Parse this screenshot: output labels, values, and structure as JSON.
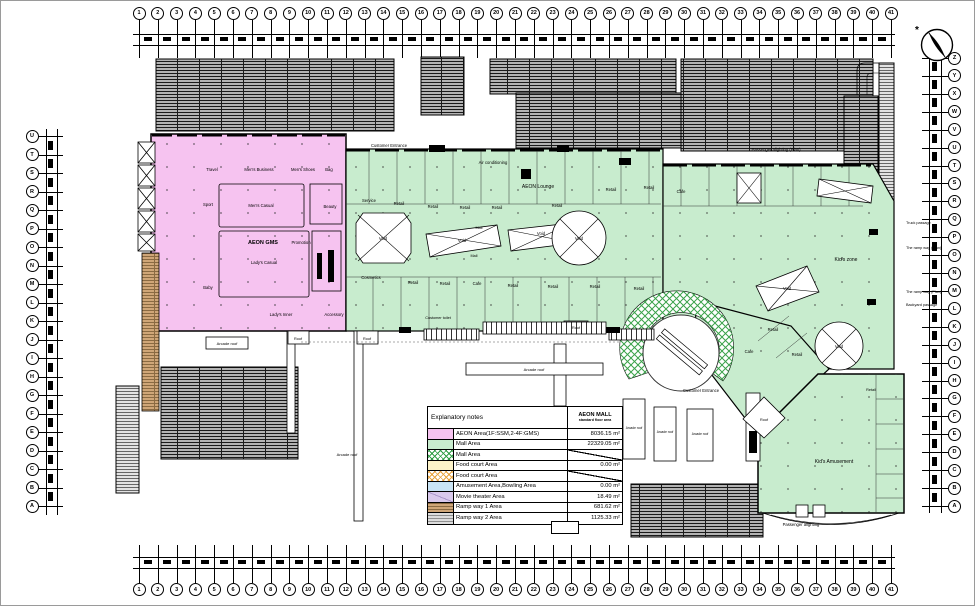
{
  "sheet": {
    "title": "AEON MALL 1F floor plan"
  },
  "colors": {
    "aeon_pink": "#f6c3f0",
    "mall_green": "#c8ecce",
    "food_yellow": "#fdf3c8",
    "amusement_blue": "#c9e4f5",
    "movie_purple": "#d9c9ec",
    "ramp1_tan": "#cfa678",
    "ramp2_gray": "#dcdcdc",
    "crosshatch_green": "#2f9e44",
    "crosshatch_orange": "#e8a33d",
    "roof_gray": "#b3b3b3"
  },
  "grid": {
    "top_numbers": [
      "1",
      "2",
      "3",
      "4",
      "5",
      "6",
      "7",
      "8",
      "9",
      "10",
      "11",
      "12",
      "13",
      "14",
      "15",
      "16",
      "17",
      "18",
      "19",
      "20",
      "21",
      "22",
      "23",
      "24",
      "25",
      "26",
      "27",
      "28",
      "29",
      "30",
      "31",
      "32",
      "33",
      "34",
      "35",
      "36",
      "37",
      "38",
      "39",
      "40",
      "41"
    ],
    "bottom_numbers": [
      "1",
      "2",
      "3",
      "4",
      "5",
      "6",
      "7",
      "8",
      "9",
      "10",
      "11",
      "12",
      "13",
      "14",
      "15",
      "16",
      "17",
      "18",
      "19",
      "20",
      "21",
      "22",
      "23",
      "24",
      "25",
      "26",
      "27",
      "28",
      "29",
      "30",
      "31",
      "32",
      "33",
      "34",
      "35",
      "36",
      "37",
      "38",
      "39",
      "40",
      "41"
    ],
    "left_letters": [
      "U",
      "T",
      "S",
      "R",
      "Q",
      "P",
      "O",
      "N",
      "M",
      "L",
      "K",
      "J",
      "I",
      "H",
      "G",
      "F",
      "E",
      "D",
      "C",
      "B",
      "A"
    ],
    "right_letters": [
      "Z",
      "Y",
      "X",
      "W",
      "V",
      "U",
      "T",
      "S",
      "R",
      "Q",
      "P",
      "O",
      "N",
      "M",
      "L",
      "K",
      "J",
      "I",
      "H",
      "G",
      "F",
      "E",
      "D",
      "C",
      "B",
      "A"
    ]
  },
  "legend": {
    "header_left": "Explanatory notes",
    "header_right_line1": "AEON MALL",
    "header_right_line2": "standard floor area",
    "rows": [
      {
        "swatch": "aeon",
        "label": "AEON Area(1F:SSM,2-4F:GMS)",
        "value": "8036.15 m²",
        "slash": false
      },
      {
        "swatch": "mall",
        "label": "Mall Area",
        "value": "22329.05 m²",
        "slash": false
      },
      {
        "swatch": "mall-cross",
        "label": "Mall Area",
        "value": "",
        "slash": true
      },
      {
        "swatch": "food",
        "label": "Food court Area",
        "value": "0.00 m²",
        "slash": false
      },
      {
        "swatch": "food-cross",
        "label": "Food court Area",
        "value": "",
        "slash": true
      },
      {
        "swatch": "amusement",
        "label": "Amusement Area,Bowling Area",
        "value": "0.00 m²",
        "slash": false
      },
      {
        "swatch": "movie",
        "label": "Movie theater Area",
        "value": "18.49 m²",
        "slash": false
      },
      {
        "swatch": "ramp1",
        "label": "Ramp way 1 Area",
        "value": "681.62 m²",
        "slash": false
      },
      {
        "swatch": "ramp2",
        "label": "Ramp way 2 Area",
        "value": "1125.33 m²",
        "slash": false
      }
    ]
  },
  "plan": {
    "labels": [
      {
        "x": 211,
        "y": 170,
        "t": "Travel"
      },
      {
        "x": 258,
        "y": 170,
        "t": "Men's Business"
      },
      {
        "x": 302,
        "y": 170,
        "t": "Men's Shoes"
      },
      {
        "x": 328,
        "y": 170,
        "t": "Bag"
      },
      {
        "x": 207,
        "y": 205,
        "t": "Sport"
      },
      {
        "x": 260,
        "y": 206,
        "t": "Men's Casual"
      },
      {
        "x": 329,
        "y": 207,
        "t": "Beauty"
      },
      {
        "x": 262,
        "y": 243,
        "t": "AEON GMS",
        "s": 5.5,
        "b": 1
      },
      {
        "x": 300,
        "y": 243,
        "t": "Promotion"
      },
      {
        "x": 263,
        "y": 263,
        "t": "Lady's Casual"
      },
      {
        "x": 207,
        "y": 288,
        "t": "Baby"
      },
      {
        "x": 280,
        "y": 315,
        "t": "Lady's Inner"
      },
      {
        "x": 333,
        "y": 315,
        "t": "Accessory"
      },
      {
        "x": 388,
        "y": 146,
        "t": "Customer Entrance"
      },
      {
        "x": 492,
        "y": 163,
        "t": "Air conditioning"
      },
      {
        "x": 537,
        "y": 187,
        "t": "AEON Lounge",
        "s": 5
      },
      {
        "x": 775,
        "y": 150,
        "t": "Passenger alighting (Plan)"
      },
      {
        "x": 370,
        "y": 278,
        "t": "Cosmetics"
      },
      {
        "x": 845,
        "y": 260,
        "t": "Kid's zone",
        "s": 5
      },
      {
        "x": 833,
        "y": 462,
        "t": "Kid's Amusement",
        "s": 5
      },
      {
        "x": 700,
        "y": 391,
        "t": "Customer Entrance"
      },
      {
        "x": 800,
        "y": 525,
        "t": "Passenger alighting"
      },
      {
        "x": 382,
        "y": 239,
        "t": "Void"
      },
      {
        "x": 461,
        "y": 241,
        "t": "Void"
      },
      {
        "x": 540,
        "y": 234,
        "t": "Void"
      },
      {
        "x": 578,
        "y": 239,
        "t": "Void"
      },
      {
        "x": 838,
        "y": 347,
        "t": "Void"
      },
      {
        "x": 786,
        "y": 289,
        "t": "Void"
      },
      {
        "x": 905,
        "y": 223,
        "t": "Truck passage",
        "s": 3.8,
        "a": "s"
      },
      {
        "x": 905,
        "y": 248,
        "t": "The ramp way (Plan)",
        "s": 3.8,
        "a": "s"
      },
      {
        "x": 905,
        "y": 292,
        "t": "The ramp way (Plan)",
        "s": 3.8,
        "a": "s"
      },
      {
        "x": 905,
        "y": 305,
        "t": "Backyard passage",
        "s": 3.8,
        "a": "s"
      },
      {
        "x": 297,
        "y": 339,
        "t": "Roof",
        "s": 3.8
      },
      {
        "x": 366,
        "y": 339,
        "t": "Roof",
        "s": 3.8
      },
      {
        "x": 575,
        "y": 328,
        "t": "Roof",
        "s": 3.8
      },
      {
        "x": 226,
        "y": 344,
        "t": "Arcade roof",
        "s": 4
      },
      {
        "x": 533,
        "y": 370,
        "t": "Arcade roof",
        "s": 4
      },
      {
        "x": 346,
        "y": 455,
        "t": "Arcade roof",
        "s": 4
      },
      {
        "x": 633,
        "y": 428,
        "t": "Arcade roof",
        "s": 3.2
      },
      {
        "x": 664,
        "y": 432,
        "t": "Arcade roof",
        "s": 3.2
      },
      {
        "x": 699,
        "y": 434,
        "t": "Arcade roof",
        "s": 3.2
      },
      {
        "x": 763,
        "y": 420,
        "t": "Roof",
        "s": 3.8
      },
      {
        "x": 437,
        "y": 318,
        "t": "Customer toilet",
        "s": 3.8
      },
      {
        "x": 478,
        "y": 228,
        "t": "Mall",
        "s": 3.8
      },
      {
        "x": 473,
        "y": 256,
        "t": "Mall",
        "s": 3.8
      },
      {
        "x": 368,
        "y": 201,
        "t": "Service"
      },
      {
        "x": 398,
        "y": 204,
        "t": "Retail"
      },
      {
        "x": 432,
        "y": 207,
        "t": "Retail"
      },
      {
        "x": 464,
        "y": 208,
        "t": "Retail"
      },
      {
        "x": 496,
        "y": 208,
        "t": "Retail"
      },
      {
        "x": 556,
        "y": 206,
        "t": "Retail"
      },
      {
        "x": 610,
        "y": 190,
        "t": "Retail"
      },
      {
        "x": 648,
        "y": 188,
        "t": "Retail"
      },
      {
        "x": 680,
        "y": 192,
        "t": "Cafe"
      },
      {
        "x": 412,
        "y": 283,
        "t": "Retail"
      },
      {
        "x": 444,
        "y": 284,
        "t": "Retail"
      },
      {
        "x": 476,
        "y": 284,
        "t": "Cafe"
      },
      {
        "x": 512,
        "y": 286,
        "t": "Retail"
      },
      {
        "x": 552,
        "y": 287,
        "t": "Retail"
      },
      {
        "x": 594,
        "y": 287,
        "t": "Retail"
      },
      {
        "x": 638,
        "y": 289,
        "t": "Retail"
      },
      {
        "x": 772,
        "y": 330,
        "t": "Retail"
      },
      {
        "x": 748,
        "y": 352,
        "t": "Cafe"
      },
      {
        "x": 796,
        "y": 355,
        "t": "Retail"
      },
      {
        "x": 870,
        "y": 390,
        "t": "Retail",
        "s": 3.8
      }
    ]
  }
}
